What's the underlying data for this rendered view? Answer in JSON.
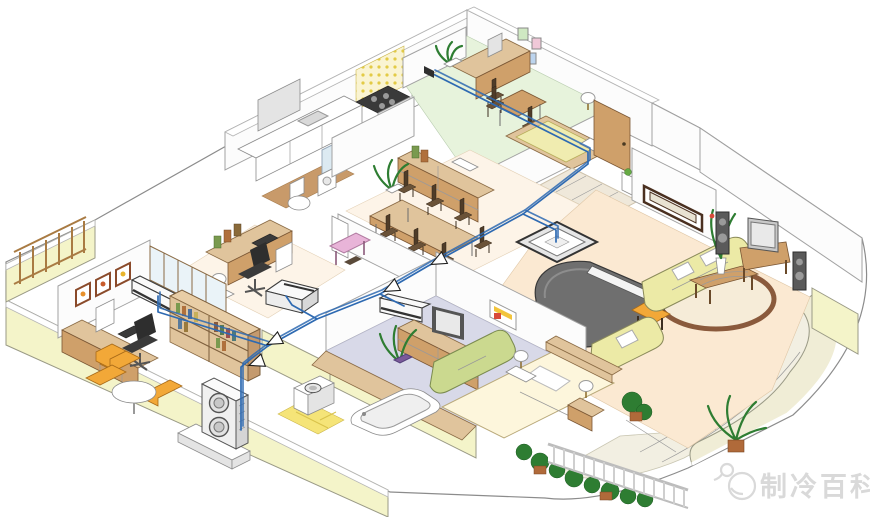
{
  "meta": {
    "type": "isometric-home-air-conditioning-diagram",
    "description": "Isometric cutaway illustration of an apartment showing a multi-split air-conditioning system: one outdoor unit on a pedestal connected by blue refrigerant piping (with flow arrows) to indoor units in several rooms"
  },
  "watermark": {
    "text": "制冷百科",
    "icon": "chat-bubble-mascot-icon"
  },
  "piping": {
    "arrow_count": 4,
    "route": "kids-room wall unit → entrance corner → living-room ceiling cassette branch → bedroom wall unit branch → study floor console branch → office wall unit branch → outdoor unit"
  },
  "equipment": [
    "outdoor-unit-on-pedestal",
    "living-room-ceiling-cassette-unit",
    "bedroom-wall-unit",
    "office-wall-unit",
    "study-floor-console-unit",
    "kids-room-pipe-connection"
  ],
  "rooms": [
    "kids-room",
    "kitchen",
    "toilet-room",
    "dining-room",
    "entrance-hall",
    "living-room",
    "study-room",
    "home-office",
    "hallway",
    "master-bedroom",
    "bathroom",
    "balcony"
  ],
  "colors": {
    "pipe": "#2e6ab2",
    "wallCut": "#f4f4c9",
    "floorGreen": "#e7f3dc",
    "floorPeach": "#fbe9d2",
    "floorLavender": "#d8d9e8",
    "balconyTile": "#f2efe2",
    "woodLight": "#e0c49c",
    "woodMid": "#cfa06a",
    "woodDark": "#5d4632",
    "sofaYellow": "#eceaa6",
    "sofaGreen": "#cbd98f",
    "chairOrange": "#f2a838",
    "pianoGray": "#6f6f6f",
    "rugBrown": "#8a5a3c",
    "tileYellow": "#f5e478",
    "plantGreen": "#2e7d32",
    "watermarkGray": "#d9d9d9"
  }
}
